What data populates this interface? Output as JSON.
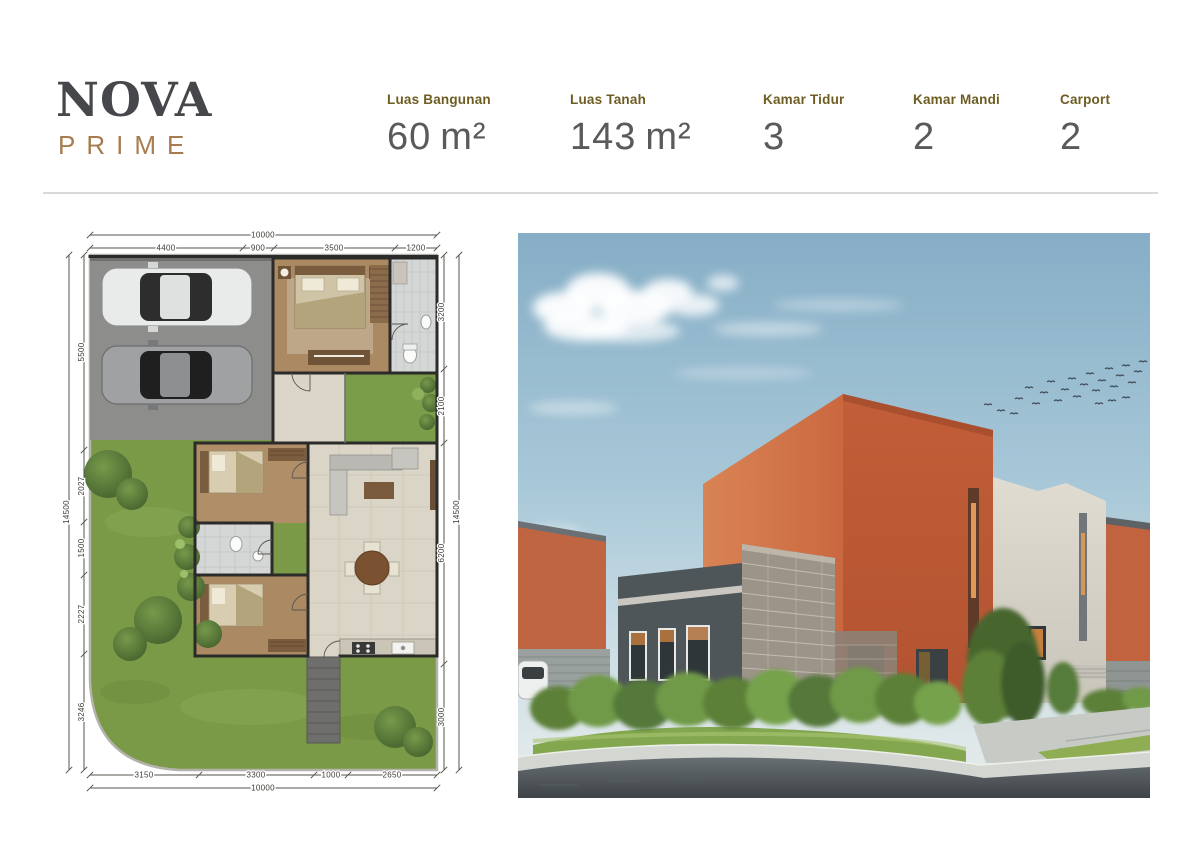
{
  "header": {
    "logo": {
      "name": "NOVA",
      "sub": "PRIME"
    },
    "specs": [
      {
        "label": "Luas Bangunan",
        "value": "60",
        "unit": "m²"
      },
      {
        "label": "Luas Tanah",
        "value": "143",
        "unit": "m²"
      },
      {
        "label": "Kamar Tidur",
        "value": "3",
        "unit": ""
      },
      {
        "label": "Kamar Mandi",
        "value": "2",
        "unit": ""
      },
      {
        "label": "Carport",
        "value": "2",
        "unit": ""
      }
    ]
  },
  "floor_plan": {
    "dims": {
      "top_total": "10000",
      "top": [
        "4400",
        "900",
        "3500",
        "1200"
      ],
      "bottom": [
        "3150",
        "3300",
        "1000",
        "2650"
      ],
      "bottom_total": "10000",
      "left_total": "14500",
      "left": [
        "5500",
        "2027",
        "1500",
        "2227",
        "3246"
      ],
      "right": [
        "3200",
        "2100",
        "6200",
        "3000"
      ],
      "right_total": "14500"
    }
  },
  "colors": {
    "brand_dark": "#45474b",
    "brand_bronze": "#a87c50",
    "spec_label_olive": "#6e5d22",
    "spec_value_gray": "#595a5c",
    "plan_grass_green": "#7a9a47",
    "plan_wood_brown": "#aa8963",
    "plan_pavement_gray": "#8d8d8b",
    "render_orange": "#c05c38",
    "render_stone_gray": "#9c9489",
    "render_sky_blue": "#a8c8d8"
  }
}
